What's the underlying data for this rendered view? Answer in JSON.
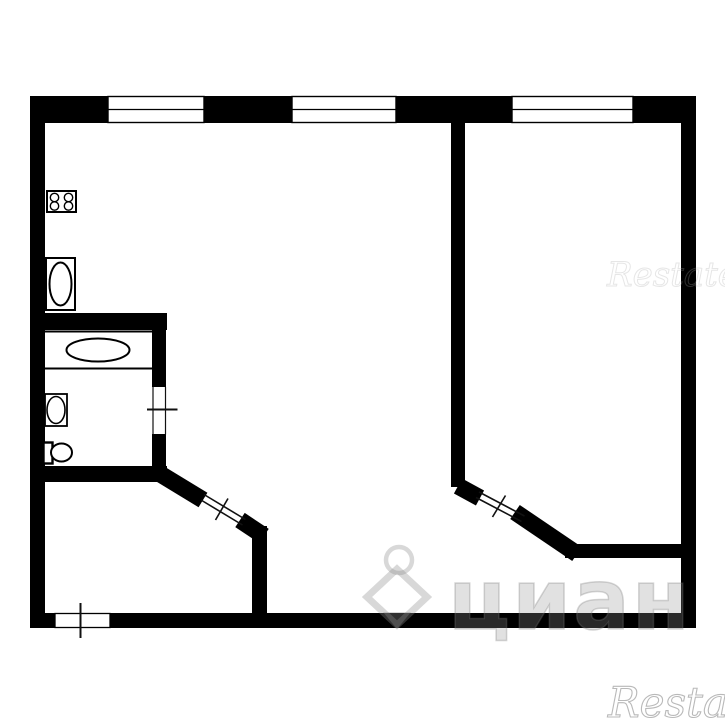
{
  "colors": {
    "wall": "#000000",
    "line": "#111111",
    "background": "#ffffff",
    "watermark_gray": "#8f8f8f"
  },
  "watermarks": {
    "restate_top": {
      "text": "Restate"
    },
    "restate_bottom": {
      "text": "Restate"
    },
    "cian": {
      "text": "циан",
      "logo": "cian-pin-logo"
    }
  },
  "plan": {
    "walls": [
      {
        "name": "outer-wall-top",
        "x": 30,
        "y": 96,
        "w": 666,
        "h": 27
      },
      {
        "name": "outer-wall-left",
        "x": 30,
        "y": 96,
        "w": 15,
        "h": 532
      },
      {
        "name": "outer-wall-right",
        "x": 681,
        "y": 96,
        "w": 15,
        "h": 532
      },
      {
        "name": "outer-wall-bottom",
        "x": 30,
        "y": 613,
        "w": 666,
        "h": 15
      },
      {
        "name": "wall-main-divider",
        "x": 451,
        "y": 123,
        "w": 14,
        "h": 364
      },
      {
        "name": "wall-bathroom-top",
        "x": 45,
        "y": 313,
        "w": 122,
        "h": 17
      },
      {
        "name": "wall-bathroom-right-upper",
        "x": 152,
        "y": 330,
        "w": 14,
        "h": 57
      },
      {
        "name": "wall-bathroom-right-lower",
        "x": 152,
        "y": 434,
        "w": 14,
        "h": 32
      },
      {
        "name": "wall-bathroom-bottom",
        "x": 45,
        "y": 466,
        "w": 122,
        "h": 16
      },
      {
        "name": "wall-hall-right",
        "x": 252,
        "y": 526,
        "w": 15,
        "h": 87
      },
      {
        "name": "wall-bedroom-bottom",
        "x": 565,
        "y": 544,
        "w": 116,
        "h": 14
      }
    ],
    "diagonal_walls": [
      {
        "name": "wall-hall-diagonal",
        "x1": 157,
        "y1": 472,
        "x2": 203,
        "y2": 500,
        "sw": 17
      },
      {
        "name": "wall-hall-diagonal-stub",
        "x1": 240,
        "y1": 520,
        "x2": 264,
        "y2": 536,
        "sw": 17
      },
      {
        "name": "wall-bedroom-door-stub",
        "x1": 458,
        "y1": 486,
        "x2": 480,
        "y2": 498,
        "sw": 17
      },
      {
        "name": "wall-bedroom-diagonal",
        "x1": 515,
        "y1": 512,
        "x2": 577,
        "y2": 554,
        "sw": 17
      }
    ],
    "windows": [
      {
        "name": "window-1",
        "x": 108,
        "y": 96.5,
        "w": 96,
        "h": 26
      },
      {
        "name": "window-2",
        "x": 292,
        "y": 96.5,
        "w": 104,
        "h": 26
      },
      {
        "name": "window-3",
        "x": 512,
        "y": 96.5,
        "w": 121,
        "h": 26
      }
    ],
    "openings": [
      {
        "name": "entry-door-opening",
        "x": 55,
        "y": 613.5,
        "w": 55,
        "h": 14
      }
    ],
    "door_lines": [
      {
        "name": "bathroom-door-gap-left-edge",
        "x1": 153,
        "y1": 387,
        "x2": 153,
        "y2": 434.5,
        "sw": 1.2
      },
      {
        "name": "bathroom-door-gap-right-edge",
        "x1": 165.5,
        "y1": 387,
        "x2": 165.5,
        "y2": 434.5,
        "sw": 1.2
      },
      {
        "name": "bathroom-door-tick",
        "x1": 147,
        "y1": 409.5,
        "x2": 177.5,
        "y2": 409.5,
        "sw": 2
      },
      {
        "name": "entry-door-tick",
        "x1": 80.5,
        "y1": 603,
        "x2": 80.5,
        "y2": 638,
        "sw": 2
      },
      {
        "name": "hall-door-leaf-a",
        "x1": 204,
        "y1": 494.5,
        "x2": 245.5,
        "y2": 519.5,
        "sw": 1.6
      },
      {
        "name": "hall-door-leaf-b",
        "x1": 201,
        "y1": 500,
        "x2": 242.5,
        "y2": 525,
        "sw": 1.6
      },
      {
        "name": "hall-door-tick",
        "x1": 228,
        "y1": 498.5,
        "x2": 215.5,
        "y2": 520,
        "sw": 1.6
      },
      {
        "name": "bedroom-door-leaf-a",
        "x1": 479,
        "y1": 492,
        "x2": 524.5,
        "y2": 516,
        "sw": 1.6
      },
      {
        "name": "bedroom-door-leaf-b",
        "x1": 476,
        "y1": 497.5,
        "x2": 521.5,
        "y2": 521.5,
        "sw": 1.6
      },
      {
        "name": "bedroom-door-tick",
        "x1": 505.5,
        "y1": 495.5,
        "x2": 492.5,
        "y2": 517,
        "sw": 1.6
      }
    ],
    "fixtures": [
      {
        "name": "stove-icon",
        "shapes": [
          {
            "t": "rect",
            "x": 47,
            "y": 191,
            "w": 29,
            "h": 21,
            "sw": 2
          },
          {
            "t": "circle",
            "cx": 54.5,
            "cy": 197.5,
            "r": 4.2,
            "sw": 1.4
          },
          {
            "t": "circle",
            "cx": 68.5,
            "cy": 197.5,
            "r": 4.2,
            "sw": 1.4
          },
          {
            "t": "circle",
            "cx": 54.5,
            "cy": 206,
            "r": 4.2,
            "sw": 1.4
          },
          {
            "t": "circle",
            "cx": 68.5,
            "cy": 206,
            "r": 4.2,
            "sw": 1.4
          }
        ]
      },
      {
        "name": "refrigerator-icon",
        "shapes": [
          {
            "t": "rect",
            "x": 46,
            "y": 258,
            "w": 29,
            "h": 52,
            "sw": 2
          },
          {
            "t": "ellipse",
            "cx": 60.5,
            "cy": 284,
            "rx": 11,
            "ry": 21.5,
            "sw": 2
          }
        ]
      },
      {
        "name": "bathtub-icon",
        "shapes": [
          {
            "t": "rect",
            "x": 44,
            "y": 331.5,
            "w": 109,
            "h": 37,
            "sw": 2
          },
          {
            "t": "ellipse",
            "cx": 98,
            "cy": 350,
            "rx": 31.5,
            "ry": 11.5,
            "sw": 2
          }
        ]
      },
      {
        "name": "sink-icon",
        "shapes": [
          {
            "t": "rect",
            "x": 45,
            "y": 394,
            "w": 22,
            "h": 32,
            "sw": 1.8
          },
          {
            "t": "ellipse",
            "cx": 56,
            "cy": 410,
            "rx": 9,
            "ry": 13.5,
            "sw": 1.6
          }
        ]
      },
      {
        "name": "toilet-icon",
        "shapes": [
          {
            "t": "rect",
            "x": 43.5,
            "y": 442.5,
            "w": 9,
            "h": 21,
            "sw": 2.4
          },
          {
            "t": "ellipse",
            "cx": 61.5,
            "cy": 452.5,
            "rx": 10.5,
            "ry": 9,
            "sw": 2
          }
        ]
      }
    ]
  }
}
